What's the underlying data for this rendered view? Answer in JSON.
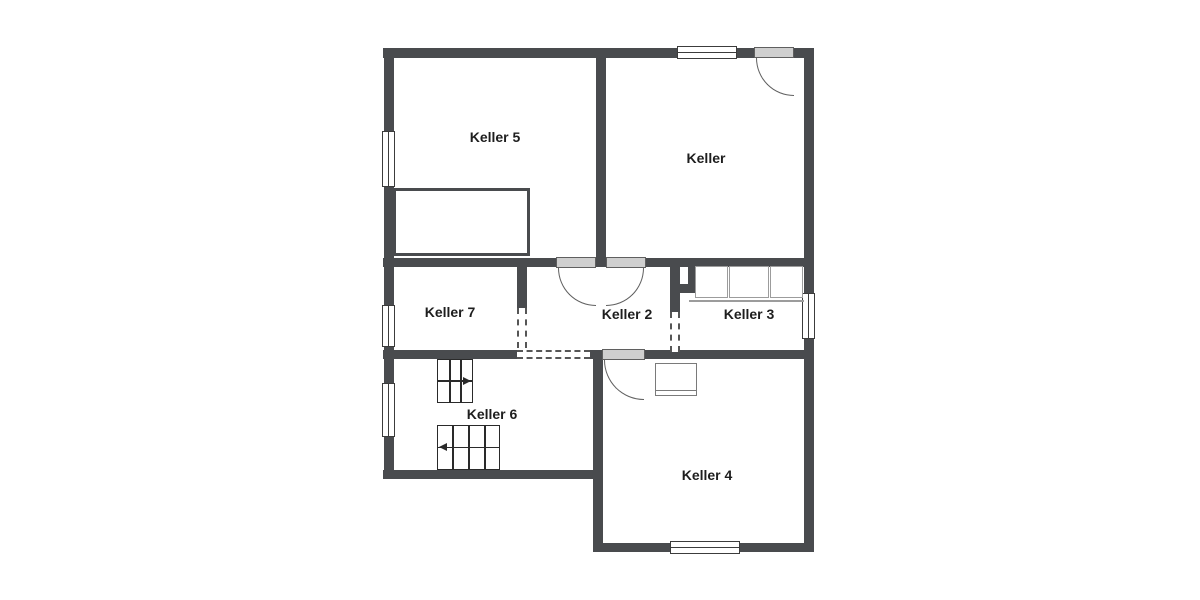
{
  "rooms": [
    {
      "label": "Keller 5"
    },
    {
      "label": "Keller"
    },
    {
      "label": "Keller 7"
    },
    {
      "label": "Keller 2"
    },
    {
      "label": "Keller 3"
    },
    {
      "label": "Keller 6"
    },
    {
      "label": "Keller 4"
    }
  ],
  "colors": {
    "background": "#ffffff",
    "wall": "#494b4e",
    "window_line": "#3c3c3c",
    "door_fill": "#cfcfcf",
    "door_line": "#5f5f5f",
    "dash": "#565656",
    "stair": "#2a2a2a",
    "fixture": "#9c9c9c",
    "text": "#1e1e1e"
  }
}
